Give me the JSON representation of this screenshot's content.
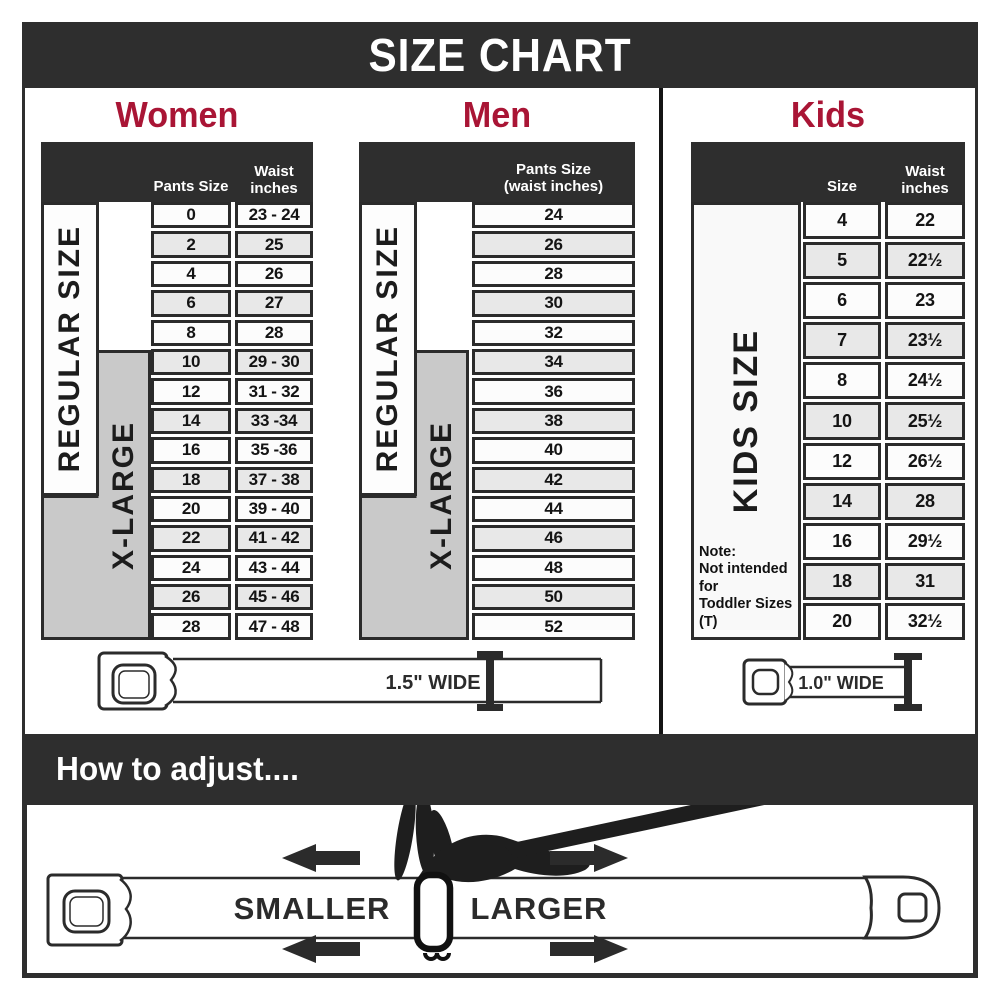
{
  "title": "SIZE CHART",
  "colors": {
    "header_bar": "#2e2e2e",
    "accent_red": "#a91535",
    "xlarge_gray": "#c9c9c9",
    "row_alt_gray": "#e8e8e8",
    "row_white": "#fcfcfc",
    "border_dark": "#2b2b2b"
  },
  "sections": {
    "women": {
      "heading": "Women",
      "col1_header": "Pants Size",
      "col2_header_l1": "Waist",
      "col2_header_l2": "inches",
      "regular_label": "REGULAR SIZE",
      "xlarge_label": "X-LARGE",
      "belt_width_label": "1.5\" WIDE"
    },
    "men": {
      "heading": "Men",
      "col_header_l1": "Pants Size",
      "col_header_l2": "(waist inches)",
      "regular_label": "REGULAR SIZE",
      "xlarge_label": "X-LARGE"
    },
    "kids": {
      "heading": "Kids",
      "col1_header": "Size",
      "col2_header_l1": "Waist",
      "col2_header_l2": "inches",
      "side_label": "KIDS SIZE",
      "note_l1": "Note:",
      "note_l2": "Not intended for",
      "note_l3": "Toddler Sizes (T)",
      "belt_width_label": "1.0\" WIDE"
    }
  },
  "adjust": {
    "heading": "How to adjust....",
    "smaller_label": "SMALLER",
    "larger_label": "LARGER"
  },
  "chart_data": [
    {
      "type": "table",
      "title": "Women",
      "columns": [
        "Pants Size",
        "Waist inches"
      ],
      "rows": [
        [
          "0",
          "23 - 24"
        ],
        [
          "2",
          "25"
        ],
        [
          "4",
          "26"
        ],
        [
          "6",
          "27"
        ],
        [
          "8",
          "28"
        ],
        [
          "10",
          "29 - 30"
        ],
        [
          "12",
          "31 - 32"
        ],
        [
          "14",
          "33 -34"
        ],
        [
          "16",
          "35 -36"
        ],
        [
          "18",
          "37 - 38"
        ],
        [
          "20",
          "39 - 40"
        ],
        [
          "22",
          "41 - 42"
        ],
        [
          "24",
          "43 - 44"
        ],
        [
          "26",
          "45 - 46"
        ],
        [
          "28",
          "47 - 48"
        ]
      ],
      "row_groups": [
        {
          "label": "REGULAR SIZE",
          "pants_sizes": "0-18"
        },
        {
          "label": "X-LARGE",
          "pants_sizes": "10-28"
        }
      ]
    },
    {
      "type": "table",
      "title": "Men",
      "columns": [
        "Pants Size (waist inches)"
      ],
      "rows": [
        [
          "24"
        ],
        [
          "26"
        ],
        [
          "28"
        ],
        [
          "30"
        ],
        [
          "32"
        ],
        [
          "34"
        ],
        [
          "36"
        ],
        [
          "38"
        ],
        [
          "40"
        ],
        [
          "42"
        ],
        [
          "44"
        ],
        [
          "46"
        ],
        [
          "48"
        ],
        [
          "50"
        ],
        [
          "52"
        ]
      ],
      "row_groups": [
        {
          "label": "REGULAR SIZE",
          "pants_sizes": "24-42"
        },
        {
          "label": "X-LARGE",
          "pants_sizes": "34-52"
        }
      ]
    },
    {
      "type": "table",
      "title": "Kids",
      "columns": [
        "Size",
        "Waist inches"
      ],
      "rows": [
        [
          "4",
          "22"
        ],
        [
          "5",
          "22½"
        ],
        [
          "6",
          "23"
        ],
        [
          "7",
          "23½"
        ],
        [
          "8",
          "24½"
        ],
        [
          "10",
          "25½"
        ],
        [
          "12",
          "26½"
        ],
        [
          "14",
          "28"
        ],
        [
          "16",
          "29½"
        ],
        [
          "18",
          "31"
        ],
        [
          "20",
          "32½"
        ]
      ]
    }
  ]
}
